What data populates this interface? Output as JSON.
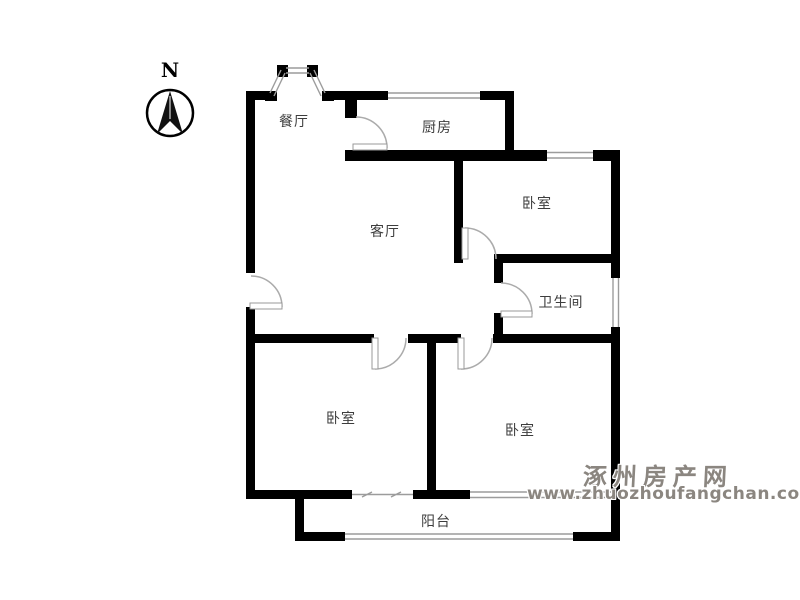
{
  "compass": {
    "label": "N"
  },
  "rooms": [
    {
      "name": "dining-room",
      "label": "餐厅"
    },
    {
      "name": "kitchen",
      "label": "厨房"
    },
    {
      "name": "bedroom-top-right",
      "label": "卧室"
    },
    {
      "name": "living-room",
      "label": "客厅"
    },
    {
      "name": "bathroom",
      "label": "卫生间"
    },
    {
      "name": "bedroom-bottom-left",
      "label": "卧室"
    },
    {
      "name": "bedroom-bottom-right",
      "label": "卧室"
    },
    {
      "name": "balcony",
      "label": "阳台"
    }
  ],
  "watermark": {
    "site_name": "涿州房产网",
    "site_url": "www.zhuozhoufangchan.com",
    "color": "#8b8680"
  },
  "colors": {
    "wall": "#000000",
    "window_line": "#9c9c9c",
    "door_arc": "#aaaaaa",
    "label_text": "#3d3d3d",
    "background": "#ffffff"
  }
}
